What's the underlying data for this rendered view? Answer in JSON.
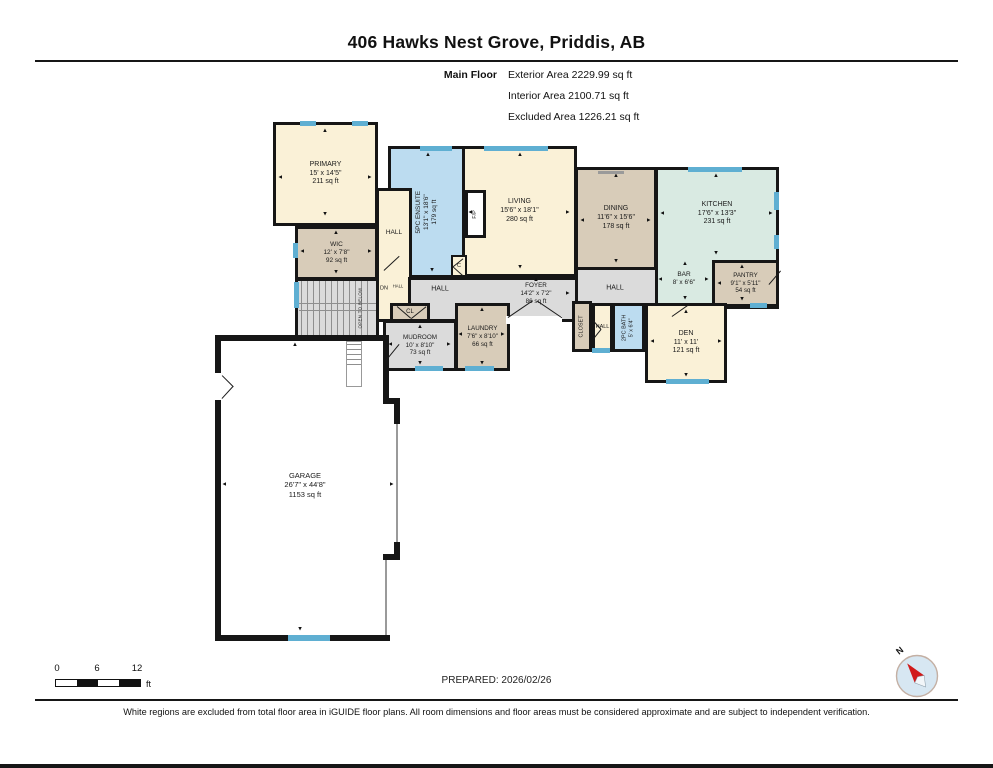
{
  "header": {
    "title": "406 Hawks Nest Grove, Priddis, AB",
    "floor_label": "Main Floor",
    "areas": [
      "Exterior Area 2229.99 sq ft",
      "Interior Area 2100.71 sq ft",
      "Excluded Area 1226.21 sq ft"
    ]
  },
  "footer": {
    "prepared": "PREPARED: 2026/02/26",
    "disclaimer": "White regions are excluded from total floor area in iGUIDE floor plans. All room dimensions and floor areas must be considered approximate and are subject to independent verification.",
    "scale": {
      "ticks": [
        "0",
        "6",
        "12"
      ],
      "unit": "ft"
    },
    "compass": {
      "label": "N"
    }
  },
  "colors": {
    "cream": "#FAF1D7",
    "tan": "#D8CCB9",
    "blue": "#BCDCF0",
    "teal": "#D9EAE2",
    "gray": "#DBDBDB",
    "white": "#FFFFFF",
    "window": "#5FAFD2",
    "wall": "#161616",
    "compass_fill": "#D7E7F2",
    "compass_needle": "#D11A1A"
  },
  "plan": {
    "rooms": [
      {
        "id": "ensuite",
        "x": 388,
        "y": 146,
        "w": 79,
        "h": 132,
        "color": "blue",
        "rot": true,
        "size": 6.5,
        "lines": [
          "5PC ENSUITE",
          "13'1\" x 18'6\"",
          "179 sq ft"
        ]
      },
      {
        "id": "hall-upper",
        "x": 376,
        "y": 188,
        "w": 36,
        "h": 134,
        "color": "cream",
        "lines": []
      },
      {
        "id": "foyer-hall-band",
        "x": 408,
        "y": 277,
        "w": 171,
        "h": 45,
        "color": "gray",
        "lines": []
      },
      {
        "id": "hall-right-band",
        "x": 575,
        "y": 267,
        "w": 84,
        "h": 40,
        "color": "gray",
        "lines": []
      },
      {
        "id": "stairs",
        "x": 295,
        "y": 278,
        "w": 84,
        "h": 62,
        "color": "gray",
        "lines": []
      },
      {
        "id": "primary",
        "x": 273,
        "y": 122,
        "w": 105,
        "h": 104,
        "color": "cream",
        "size": 7,
        "lines": [
          "PRIMARY",
          "15' x 14'5\"",
          "211 sq ft"
        ]
      },
      {
        "id": "wic",
        "x": 295,
        "y": 226,
        "w": 83,
        "h": 54,
        "color": "tan",
        "size": 6.5,
        "lines": [
          "WIC",
          "12' x 7'8\"",
          "92 sq ft"
        ]
      },
      {
        "id": "living",
        "x": 462,
        "y": 146,
        "w": 115,
        "h": 131,
        "color": "cream",
        "size": 7,
        "lines": [
          "LIVING",
          "15'6\" x 18'1\"",
          "280 sq ft"
        ]
      },
      {
        "id": "fireplace",
        "x": 465,
        "y": 190,
        "w": 21,
        "h": 48,
        "color": "white",
        "rot": true,
        "size": 5.5,
        "lines": [
          "F/P"
        ]
      },
      {
        "id": "dining",
        "x": 575,
        "y": 167,
        "w": 82,
        "h": 103,
        "color": "tan",
        "size": 7,
        "lines": [
          "DINING",
          "11'6\" x 15'6\"",
          "178 sq ft"
        ]
      },
      {
        "id": "kitchen",
        "x": 655,
        "y": 167,
        "w": 124,
        "h": 142,
        "color": "teal",
        "size": 7,
        "dy": -24,
        "lines": [
          "KITCHEN",
          "17'6\" x 13'3\"",
          "231 sq ft"
        ]
      },
      {
        "id": "pantry",
        "x": 712,
        "y": 260,
        "w": 67,
        "h": 47,
        "color": "tan",
        "size": 6.2,
        "lines": [
          "PANTRY",
          "9'1\" x 5'11\"",
          "54 sq ft"
        ]
      },
      {
        "id": "closet-cl",
        "x": 390,
        "y": 303,
        "w": 40,
        "h": 19,
        "color": "tan",
        "size": 6,
        "lines": [
          "CL"
        ]
      },
      {
        "id": "mudroom",
        "x": 383,
        "y": 320,
        "w": 74,
        "h": 51,
        "color": "gray",
        "size": 6.3,
        "lines": [
          "MUDROOM",
          "10' x 8'10\"",
          "73 sq ft"
        ]
      },
      {
        "id": "laundry",
        "x": 455,
        "y": 303,
        "w": 55,
        "h": 68,
        "color": "tan",
        "size": 6.3,
        "lines": [
          "LAUNDRY",
          "7'6\" x 8'10\"",
          "66 sq ft"
        ]
      },
      {
        "id": "closet",
        "x": 572,
        "y": 301,
        "w": 20,
        "h": 51,
        "color": "tan",
        "rot": true,
        "size": 5.5,
        "lines": [
          "CLOSET"
        ]
      },
      {
        "id": "hall-small",
        "x": 592,
        "y": 303,
        "w": 21,
        "h": 49,
        "color": "cream",
        "size": 5.5,
        "lines": [
          "HALL"
        ]
      },
      {
        "id": "bath-2pc",
        "x": 612,
        "y": 303,
        "w": 33,
        "h": 49,
        "color": "blue",
        "rot": true,
        "size": 5.5,
        "lines": [
          "2PC BATH",
          "5' x 6'4\""
        ]
      },
      {
        "id": "den",
        "x": 645,
        "y": 303,
        "w": 82,
        "h": 80,
        "color": "cream",
        "size": 7,
        "lines": [
          "DEN",
          "11' x 11'",
          "121 sq ft"
        ]
      },
      {
        "id": "closet-c",
        "x": 451,
        "y": 255,
        "w": 16,
        "h": 22,
        "color": "cream",
        "b": 2,
        "size": 5.5,
        "lines": [
          "C"
        ]
      }
    ],
    "labels": [
      {
        "id": "garage",
        "x": 305,
        "y": 485,
        "size": 7.5,
        "lines": [
          "GARAGE",
          "26'7\" x 44'8\"",
          "1153 sq ft"
        ]
      },
      {
        "id": "foyer",
        "x": 536,
        "y": 294,
        "size": 6.3,
        "lines": [
          "FOYER",
          "14'2\" x 7'2\"",
          "86 sq ft"
        ]
      },
      {
        "id": "bar",
        "x": 684,
        "y": 279,
        "size": 6.5,
        "lines": [
          "BAR",
          "8' x 6'6\""
        ]
      },
      {
        "id": "hall-left",
        "x": 440,
        "y": 290,
        "size": 7,
        "lines": [
          "HALL"
        ]
      },
      {
        "id": "hall-right",
        "x": 615,
        "y": 289,
        "size": 7,
        "lines": [
          "HALL"
        ]
      },
      {
        "id": "hall-wic",
        "x": 394,
        "y": 233,
        "size": 6.5,
        "lines": [
          "HALL"
        ]
      },
      {
        "id": "dn",
        "x": 384,
        "y": 289,
        "size": 5.5,
        "lines": [
          "DN"
        ]
      },
      {
        "id": "dn-hall",
        "x": 398,
        "y": 286,
        "size": 4.2,
        "lines": [
          "HALL"
        ]
      },
      {
        "id": "open-to-below",
        "x": 360,
        "y": 308,
        "rot": true,
        "size": 4.3,
        "lines": [
          "OPEN TO BELOW"
        ]
      }
    ],
    "windows": [
      [
        300,
        121,
        16,
        5
      ],
      [
        352,
        121,
        16,
        5
      ],
      [
        293,
        243,
        5,
        15
      ],
      [
        294,
        282,
        5,
        26
      ],
      [
        420,
        146,
        32,
        5
      ],
      [
        484,
        146,
        64,
        5
      ],
      [
        688,
        167,
        54,
        5
      ],
      [
        774,
        192,
        5,
        18
      ],
      [
        774,
        235,
        5,
        14
      ],
      [
        750,
        303,
        17,
        5
      ],
      [
        592,
        348,
        18,
        5
      ],
      [
        666,
        379,
        43,
        5
      ],
      [
        415,
        366,
        28,
        5
      ],
      [
        465,
        366,
        29,
        5
      ],
      [
        288,
        635,
        42,
        6
      ]
    ],
    "walls": [
      [
        215,
        335,
        172,
        6
      ],
      [
        215,
        335,
        6,
        306
      ],
      [
        215,
        635,
        175,
        6
      ],
      [
        383,
        335,
        6,
        69
      ],
      [
        383,
        398,
        17,
        6
      ],
      [
        394,
        398,
        6,
        26
      ],
      [
        394,
        542,
        6,
        18
      ],
      [
        383,
        554,
        17,
        6
      ]
    ],
    "white_gaps": [
      [
        506,
        316,
        56,
        8
      ],
      [
        214,
        373,
        8,
        27
      ]
    ],
    "gray_lines": [
      [
        396,
        424,
        2,
        120
      ],
      [
        385,
        560,
        2,
        76
      ],
      [
        598,
        171,
        26,
        3
      ]
    ],
    "doors": [
      [
        384,
        271,
        399,
        257
      ],
      [
        463,
        259,
        453,
        267
      ],
      [
        463,
        276,
        453,
        267
      ],
      [
        508,
        318,
        533,
        301
      ],
      [
        562,
        318,
        537,
        301
      ],
      [
        397,
        307,
        411,
        319
      ],
      [
        426,
        307,
        411,
        319
      ],
      [
        386,
        361,
        399,
        345
      ],
      [
        222,
        376,
        233,
        387
      ],
      [
        222,
        399,
        233,
        387
      ],
      [
        769,
        285,
        781,
        271
      ],
      [
        672,
        317,
        689,
        305
      ],
      [
        593,
        321,
        601,
        330
      ],
      [
        593,
        340,
        601,
        330
      ]
    ],
    "arrows": [
      [
        325,
        131,
        "u"
      ],
      [
        325,
        213,
        "d"
      ],
      [
        281,
        177,
        "l"
      ],
      [
        369,
        177,
        "r"
      ],
      [
        336,
        233,
        "u"
      ],
      [
        336,
        271,
        "d"
      ],
      [
        303,
        251,
        "l"
      ],
      [
        369,
        251,
        "r"
      ],
      [
        428,
        155,
        "u"
      ],
      [
        432,
        269,
        "d"
      ],
      [
        520,
        155,
        "u"
      ],
      [
        520,
        266,
        "d"
      ],
      [
        471,
        212,
        "l"
      ],
      [
        567,
        212,
        "r"
      ],
      [
        616,
        176,
        "u"
      ],
      [
        616,
        260,
        "d"
      ],
      [
        583,
        220,
        "l"
      ],
      [
        648,
        220,
        "r"
      ],
      [
        716,
        176,
        "u"
      ],
      [
        716,
        252,
        "d"
      ],
      [
        663,
        213,
        "l"
      ],
      [
        770,
        213,
        "r"
      ],
      [
        742,
        267,
        "u"
      ],
      [
        742,
        298,
        "d"
      ],
      [
        720,
        283,
        "l"
      ],
      [
        685,
        264,
        "u"
      ],
      [
        685,
        297,
        "d"
      ],
      [
        661,
        279,
        "l"
      ],
      [
        706,
        279,
        "r"
      ],
      [
        536,
        280,
        "u"
      ],
      [
        567,
        293,
        "r"
      ],
      [
        420,
        327,
        "u"
      ],
      [
        420,
        362,
        "d"
      ],
      [
        391,
        344,
        "l"
      ],
      [
        448,
        344,
        "r"
      ],
      [
        482,
        310,
        "u"
      ],
      [
        482,
        362,
        "d"
      ],
      [
        461,
        334,
        "l"
      ],
      [
        502,
        334,
        "r"
      ],
      [
        686,
        312,
        "u"
      ],
      [
        686,
        374,
        "d"
      ],
      [
        653,
        341,
        "l"
      ],
      [
        719,
        341,
        "r"
      ],
      [
        295,
        345,
        "u"
      ],
      [
        300,
        628,
        "d"
      ],
      [
        225,
        484,
        "l"
      ],
      [
        391,
        484,
        "r"
      ]
    ],
    "stairs": {
      "treads_x": {
        "from": 301,
        "to": 372,
        "step": 6,
        "y": 281,
        "h": 56
      },
      "rails_y": [
        303,
        310
      ],
      "below_box": [
        346,
        341,
        16,
        46
      ],
      "below_treads": {
        "from": 344,
        "to": 364,
        "step": 5,
        "x": 347,
        "w": 14
      }
    }
  }
}
